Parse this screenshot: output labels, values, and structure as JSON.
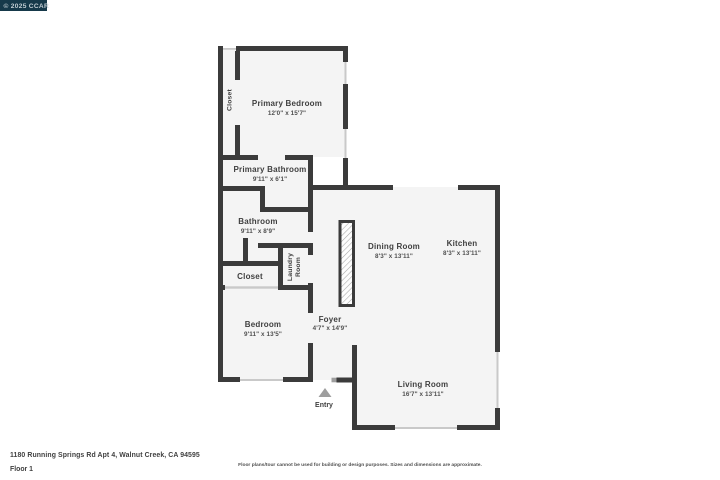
{
  "watermark": {
    "text": "© 2025 CCAR"
  },
  "floorplan": {
    "rooms": [
      {
        "id": "primary-bedroom",
        "name": "Primary Bedroom",
        "dimensions": "12'0\" x 15'7\""
      },
      {
        "id": "primary-bedroom-closet",
        "name": "Closet",
        "dimensions": ""
      },
      {
        "id": "primary-bathroom",
        "name": "Primary Bathroom",
        "dimensions": "9'11\" x 6'1\""
      },
      {
        "id": "bathroom",
        "name": "Bathroom",
        "dimensions": "9'11\" x 8'9\""
      },
      {
        "id": "hall-closet",
        "name": "Closet",
        "dimensions": ""
      },
      {
        "id": "laundry-room",
        "name": "Laundry Room",
        "name_line1": "Laundry",
        "name_line2": "Room",
        "dimensions": ""
      },
      {
        "id": "bedroom",
        "name": "Bedroom",
        "dimensions": "9'11\" x 13'5\""
      },
      {
        "id": "foyer",
        "name": "Foyer",
        "dimensions": "4'7\" x 14'9\""
      },
      {
        "id": "dining-room",
        "name": "Dining Room",
        "dimensions": "8'3\" x 13'11\""
      },
      {
        "id": "kitchen",
        "name": "Kitchen",
        "dimensions": "8'3\" x 13'11\""
      },
      {
        "id": "living-room",
        "name": "Living Room",
        "dimensions": "16'7\" x 13'11\""
      }
    ],
    "entry_label": "Entry"
  },
  "footer": {
    "address": "1180 Running Springs Rd Apt 4, Walnut Creek, CA 94595",
    "floor": "Floor 1",
    "disclaimer": "Floor plans/tour cannot be used for building or design purposes. Sizes and dimensions are approximate."
  },
  "colors": {
    "wall": "#3b3b3b",
    "floor": "#f4f4f4",
    "window": "#c9c9c9",
    "entry_arrow": "#9e9e9e",
    "label": "#3f3f3f",
    "dimension": "#4f4f4f",
    "watermark_bg": "#16394a",
    "watermark_text": "#c3ced4",
    "background": "#ffffff"
  }
}
